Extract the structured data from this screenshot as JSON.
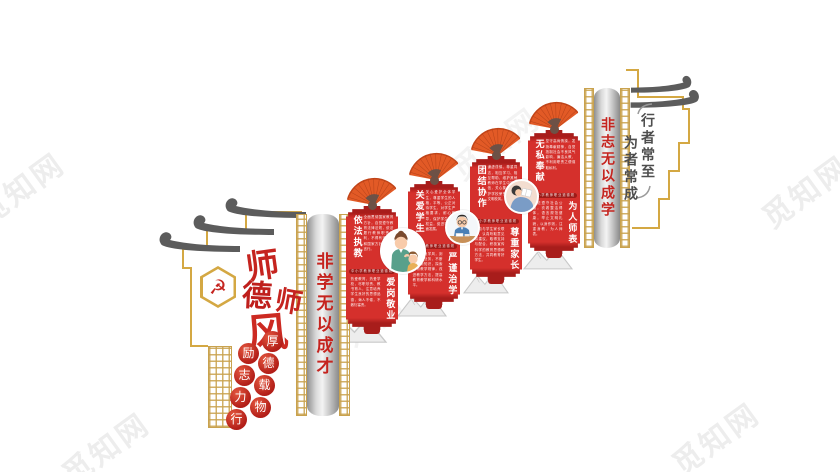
{
  "site_watermark": {
    "text": "觅知网"
  },
  "palette": {
    "banner_red": "#d5302c",
    "band_red": "#9e1b18",
    "gold": "#c9a24e",
    "fan_orange": "#e25a26",
    "calligraphy_red": "#c5241f",
    "motto_gray": "#4e4e4e"
  },
  "left_header": {
    "emblem_glyph": "☭",
    "title_chars": [
      "师",
      "德",
      "师",
      "风"
    ],
    "seal_primary_chars": [
      "厚",
      "德",
      "载",
      "物"
    ],
    "seal_secondary_chars": [
      "励",
      "志",
      "力",
      "行"
    ]
  },
  "left_pillar": {
    "text": "非学无以成才"
  },
  "right_pillar": {
    "text": "非志无以成学"
  },
  "banners": [
    {
      "heading_top": "依法执教",
      "text_top": "全面贯彻国家教育方针，自觉遵守教育法律法规，依法履行教师职责权利，不得有违背党和国家方针政策的言行。",
      "band": "中小学教师职业道德规范",
      "heading_bottom": "爱岗敬业",
      "text_bottom": "热爱教育、热爱学校，尽职尽责、教书育人，注意培养学生良好的思想品德，诲人不倦，不敷衍塞责。"
    },
    {
      "heading_top": "关爱学生",
      "text_top": "关心爱护全体学生，尊重学生的人格，平等、公正对待学生，对学生严格要求，耐心教导，保护学生合法权益，促进学生全面发展。",
      "band": "中小学教师职业道德规范",
      "heading_bottom": "严谨治学",
      "text_bottom": "树立优良学风，刻苦钻研业务，不断学习新知识，探索教育教学规律，改进教学方法，提高教育教学和科研水平。"
    },
    {
      "heading_top": "团结协作",
      "text_top": "谦虚谨慎、尊重同志，相互学习、相互帮助，维护其他教师在学生中的威信，关心集体，维护学校荣誉，共创文明校风。",
      "band": "中小学教师职业道德规范",
      "heading_bottom": "尊重家长",
      "text_bottom": "主动与学生家长联系，认真听取意见和建议，取得支持与配合，积极宣传科学的教育思想和方法，共同教育好学生。"
    },
    {
      "heading_top": "无私奉献",
      "text_top": "坚守高尚情操，发扬奉献精神，自觉抵制社会不良风气影响，廉洁从教，不利用职责之便谋取私利。",
      "band": "中小学教师职业道德规范",
      "heading_bottom": "为人师表",
      "text_bottom": "模范遵守社会公德，衣着整洁得体，语言规范健康，举止文明礼貌，以身作则，注重身教，为人师表。"
    }
  ],
  "right_motto": {
    "line_right": "行者常至",
    "line_left": "为者常成"
  },
  "illustrations": [
    "teacher-with-students",
    "teacher-studying-at-desk",
    "reader-with-book"
  ]
}
